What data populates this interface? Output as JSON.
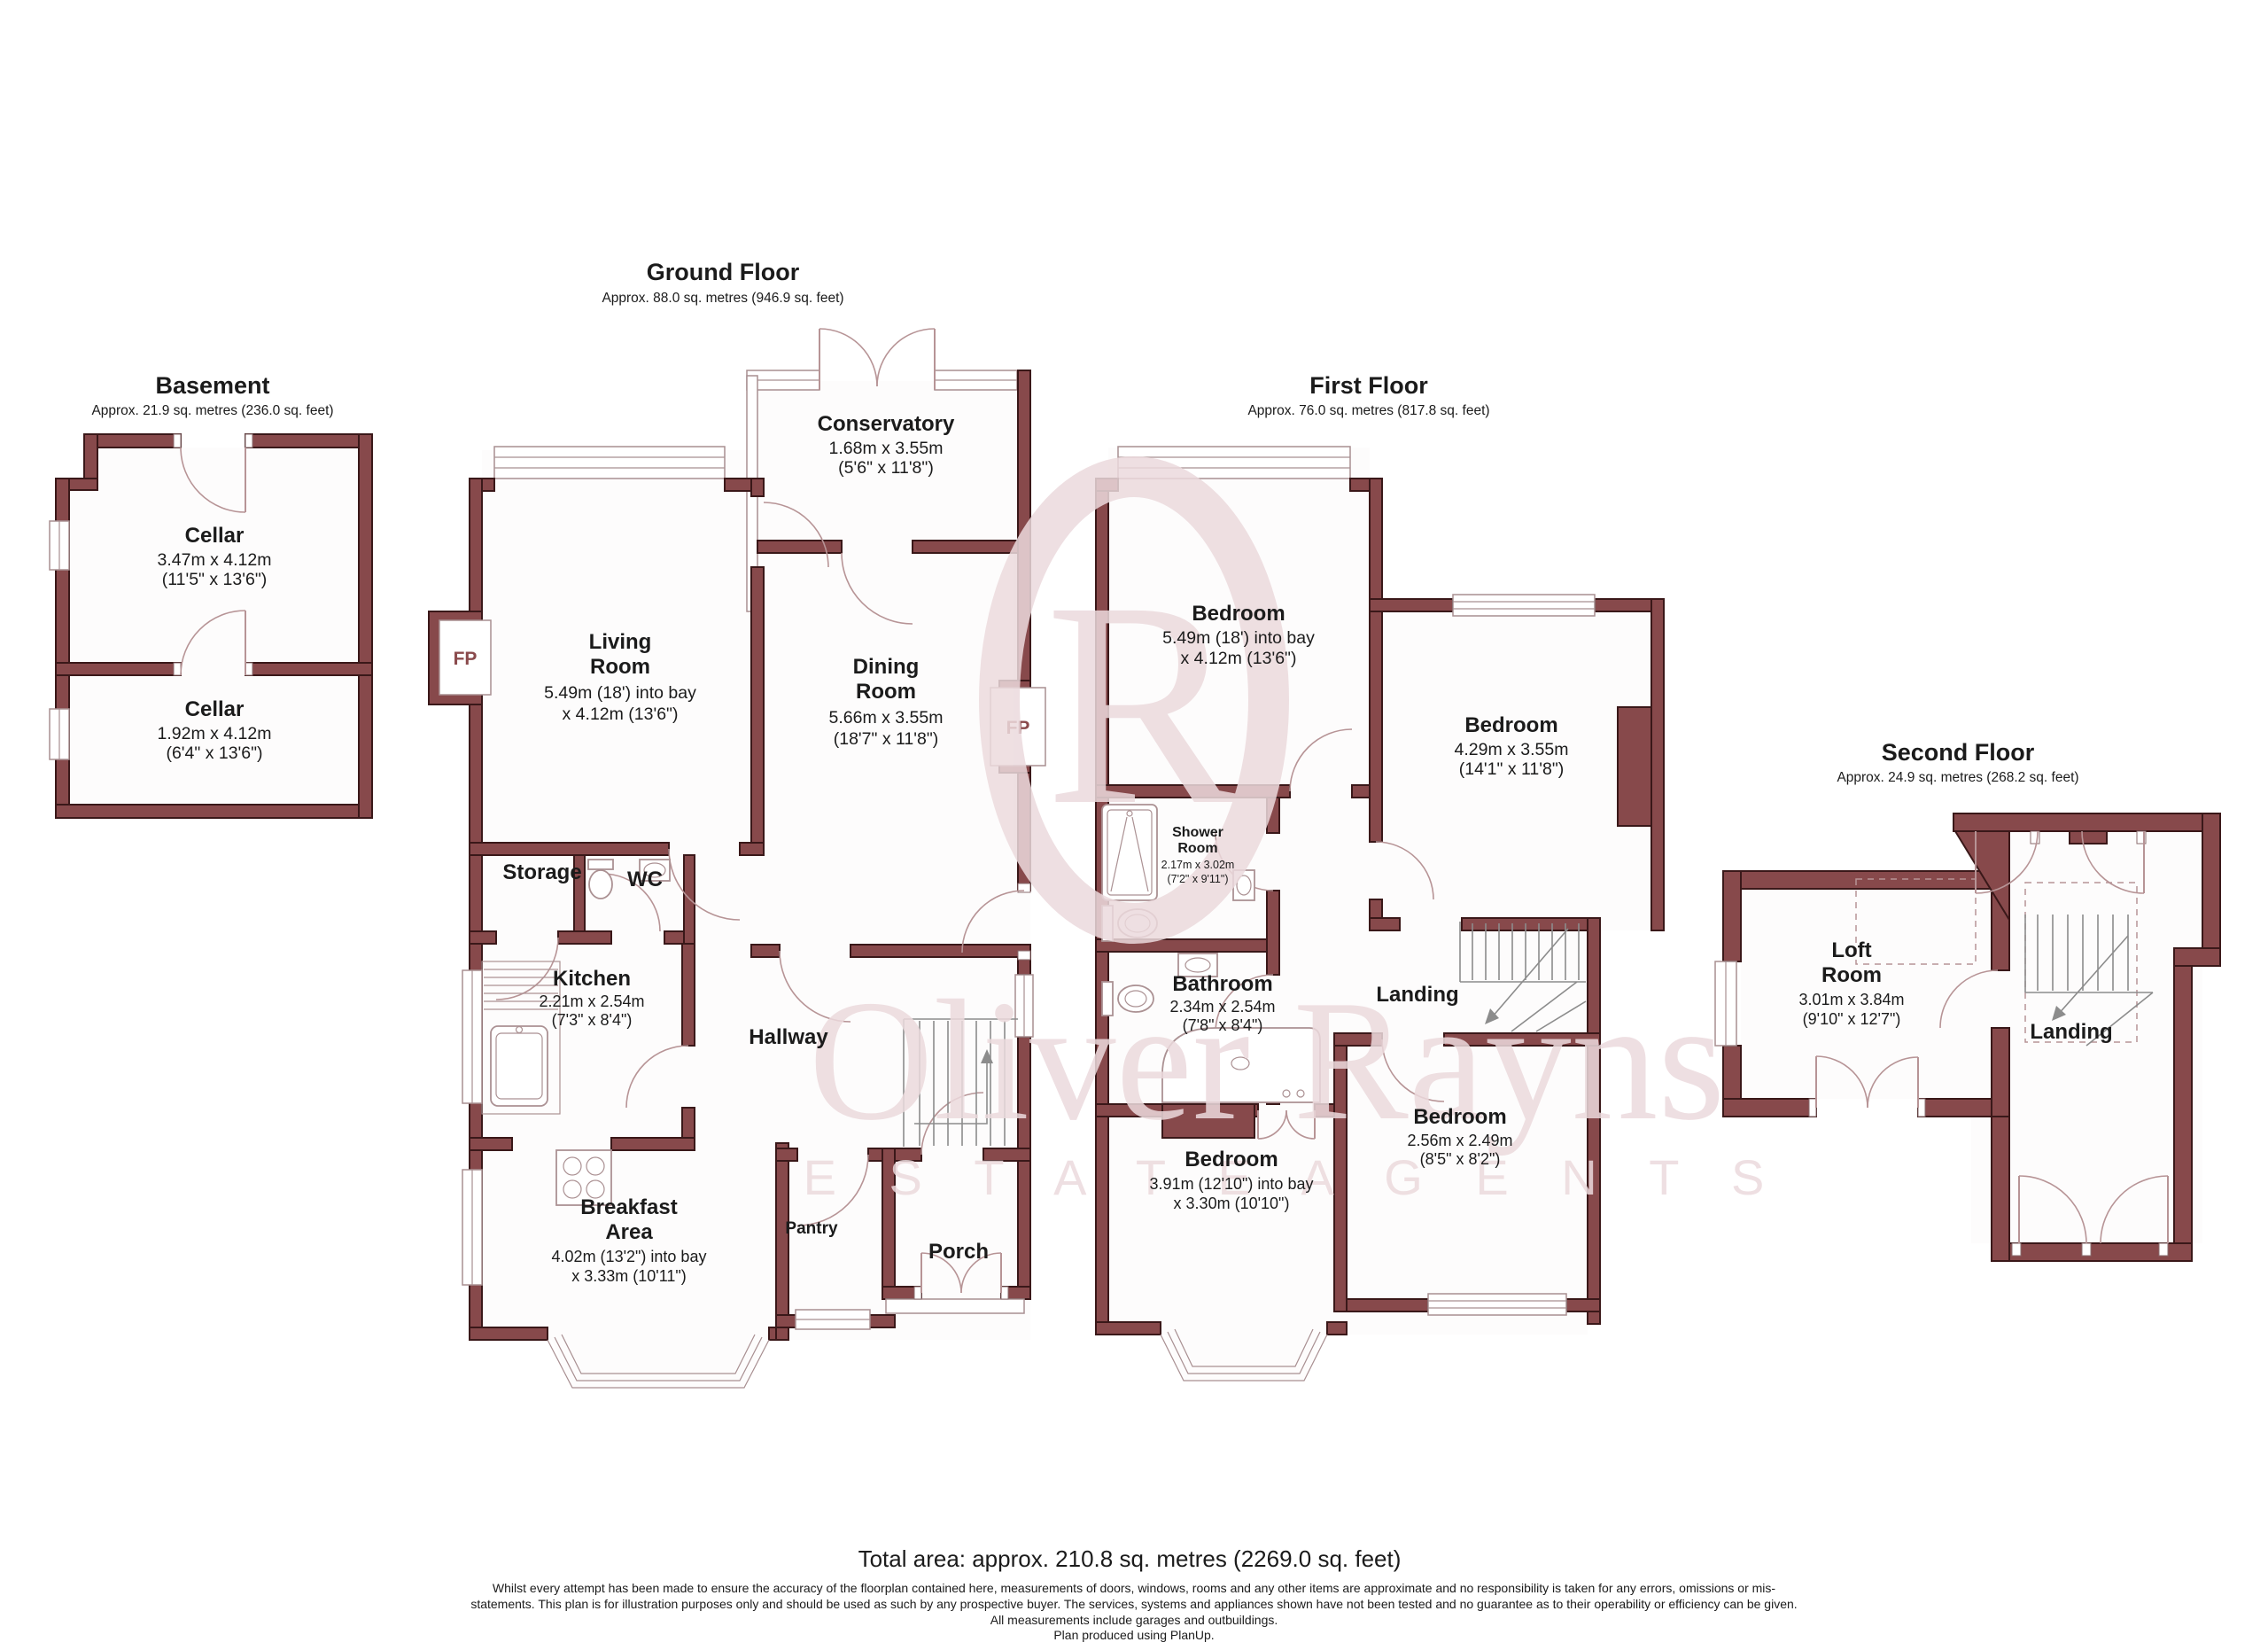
{
  "watermark": {
    "monogram": "R",
    "name": "Oliver Rayns",
    "tagline": "E S T A T E   A G E N T S"
  },
  "basement": {
    "title": "Basement",
    "subtitle": "Approx. 21.9 sq. metres (236.0 sq. feet)",
    "cellar_top": {
      "name": "Cellar",
      "metric": "3.47m x 4.12m",
      "imperial": "(11'5\" x 13'6\")"
    },
    "cellar_bottom": {
      "name": "Cellar",
      "metric": "1.92m x 4.12m",
      "imperial": "(6'4\" x 13'6\")"
    }
  },
  "ground": {
    "title": "Ground Floor",
    "subtitle": "Approx. 88.0 sq. metres (946.9 sq. feet)",
    "conservatory": {
      "name": "Conservatory",
      "metric": "1.68m x 3.55m",
      "imperial": "(5'6\" x 11'8\")"
    },
    "living": {
      "line1": "Living",
      "line2": "Room",
      "metric": "5.49m (18') into bay",
      "imperial": "x 4.12m (13'6\")"
    },
    "dining": {
      "line1": "Dining",
      "line2": "Room",
      "metric": "5.66m x 3.55m",
      "imperial": "(18'7\" x 11'8\")"
    },
    "storage": {
      "name": "Storage"
    },
    "wc": {
      "name": "WC"
    },
    "kitchen": {
      "name": "Kitchen",
      "metric": "2.21m x 2.54m",
      "imperial": "(7'3\" x 8'4\")"
    },
    "hallway": {
      "name": "Hallway"
    },
    "breakfast": {
      "line1": "Breakfast",
      "line2": "Area",
      "metric": "4.02m (13'2\") into bay",
      "imperial": "x 3.33m (10'11\")"
    },
    "pantry": {
      "name": "Pantry"
    },
    "porch": {
      "name": "Porch"
    },
    "fireplace": "FP"
  },
  "first": {
    "title": "First Floor",
    "subtitle": "Approx. 76.0 sq. metres (817.8 sq. feet)",
    "bedroom1": {
      "name": "Bedroom",
      "metric": "5.49m (18') into bay",
      "imperial": "x 4.12m (13'6\")"
    },
    "bedroom2": {
      "name": "Bedroom",
      "metric": "4.29m x 3.55m",
      "imperial": "(14'1\" x 11'8\")"
    },
    "shower": {
      "line1": "Shower",
      "line2": "Room",
      "metric": "2.17m x 3.02m",
      "imperial": "(7'2\" x 9'11\")"
    },
    "bathroom": {
      "name": "Bathroom",
      "metric": "2.34m x 2.54m",
      "imperial": "(7'8\" x 8'4\")"
    },
    "landing": {
      "name": "Landing"
    },
    "bedroom3": {
      "name": "Bedroom",
      "metric": "3.91m (12'10\") into bay",
      "imperial": "x 3.30m (10'10\")"
    },
    "bedroom4": {
      "name": "Bedroom",
      "metric": "2.56m x 2.49m",
      "imperial": "(8'5\" x 8'2\")"
    }
  },
  "second": {
    "title": "Second Floor",
    "subtitle": "Approx. 24.9 sq. metres (268.2 sq. feet)",
    "loft": {
      "line1": "Loft",
      "line2": "Room",
      "metric": "3.01m x 3.84m",
      "imperial": "(9'10\" x 12'7\")"
    },
    "landing": {
      "name": "Landing"
    }
  },
  "footer": {
    "total": "Total area: approx. 210.8 sq. metres (2269.0 sq. feet)",
    "line1": "Whilst every attempt has been made to ensure the accuracy of the floorplan contained here, measurements of doors, windows, rooms and any other items are approximate and no responsibility is taken for any errors, omissions or mis-",
    "line2": "statements.  This plan is for illustration purposes only and should be used as such by any prospective buyer. The services, systems and appliances shown have not been tested and no guarantee as to their operability or efficiency can be given.",
    "line3": "All measurements include garages and outbuildings.",
    "line4": "Plan produced using PlanUp."
  }
}
